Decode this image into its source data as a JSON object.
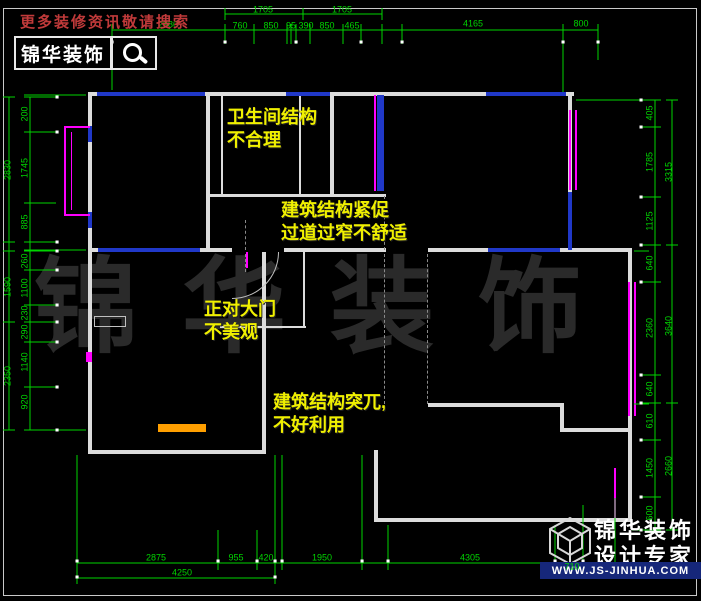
{
  "header": {
    "promo": "更多装修资讯敬请搜索",
    "brand": "锦华装饰",
    "search_icon": "magnifier-icon"
  },
  "watermark": {
    "text": "锦华装饰"
  },
  "annotations": [
    {
      "text": "卫生间结构\n不合理",
      "x": 227,
      "y": 106
    },
    {
      "text": "建筑结构紧促\n过道过窄不舒适",
      "x": 281,
      "y": 199
    },
    {
      "text": "正对大门\n不美观",
      "x": 204,
      "y": 298
    },
    {
      "text": "建筑结构突兀,\n不好利用",
      "x": 273,
      "y": 391
    }
  ],
  "dimensions": {
    "top": [
      {
        "v": "2980",
        "x": 168,
        "y": 25
      },
      {
        "v": "1705",
        "x": 263,
        "y": 10
      },
      {
        "v": "1705",
        "x": 342,
        "y": 10
      },
      {
        "v": "760",
        "x": 240,
        "y": 26
      },
      {
        "v": "850",
        "x": 271,
        "y": 26
      },
      {
        "v": "95",
        "x": 291,
        "y": 26
      },
      {
        "v": "390",
        "x": 306,
        "y": 26
      },
      {
        "v": "850",
        "x": 327,
        "y": 26
      },
      {
        "v": "465",
        "x": 352,
        "y": 26
      },
      {
        "v": "4165",
        "x": 473,
        "y": 24
      },
      {
        "v": "800",
        "x": 581,
        "y": 24
      }
    ],
    "left": [
      {
        "v": "200",
        "x": 25,
        "y": 114
      },
      {
        "v": "1745",
        "x": 25,
        "y": 168
      },
      {
        "v": "885",
        "x": 25,
        "y": 222
      },
      {
        "v": "2830",
        "x": 8,
        "y": 170
      },
      {
        "v": "260",
        "x": 25,
        "y": 261
      },
      {
        "v": "1100",
        "x": 25,
        "y": 288
      },
      {
        "v": "230",
        "x": 25,
        "y": 313
      },
      {
        "v": "1590",
        "x": 8,
        "y": 287
      },
      {
        "v": "290",
        "x": 25,
        "y": 332
      },
      {
        "v": "1140",
        "x": 25,
        "y": 362
      },
      {
        "v": "920",
        "x": 25,
        "y": 402
      },
      {
        "v": "2350",
        "x": 8,
        "y": 376
      }
    ],
    "right": [
      {
        "v": "405",
        "x": 650,
        "y": 113
      },
      {
        "v": "1785",
        "x": 650,
        "y": 162
      },
      {
        "v": "1125",
        "x": 650,
        "y": 221
      },
      {
        "v": "3315",
        "x": 669,
        "y": 172
      },
      {
        "v": "640",
        "x": 650,
        "y": 263
      },
      {
        "v": "2360",
        "x": 650,
        "y": 328
      },
      {
        "v": "640",
        "x": 650,
        "y": 389
      },
      {
        "v": "3640",
        "x": 669,
        "y": 326
      },
      {
        "v": "610",
        "x": 650,
        "y": 421
      },
      {
        "v": "1450",
        "x": 650,
        "y": 468
      },
      {
        "v": "600",
        "x": 650,
        "y": 513
      },
      {
        "v": "2660",
        "x": 669,
        "y": 466
      }
    ],
    "bottom": [
      {
        "v": "2875",
        "x": 156,
        "y": 558
      },
      {
        "v": "955",
        "x": 236,
        "y": 558
      },
      {
        "v": "420",
        "x": 266,
        "y": 558
      },
      {
        "v": "1950",
        "x": 322,
        "y": 558
      },
      {
        "v": "4305",
        "x": 470,
        "y": 558
      },
      {
        "v": "710",
        "x": 572,
        "y": 567
      },
      {
        "v": "4250",
        "x": 182,
        "y": 573
      }
    ]
  },
  "logo": {
    "line1": "锦华装饰",
    "line2": "设计专家",
    "url": "WWW.JS-JINHUA.COM"
  },
  "colors": {
    "background": "#000000",
    "dimension_green": "#00d400",
    "wall_white": "#dcdcdc",
    "window_blue": "#2038c8",
    "window_magenta": "#ff00ff",
    "counter_orange": "#ff9f00",
    "annotation_yellow": "#f0f000",
    "promo_red": "#c03a3a",
    "logo_bar_blue": "#16277a",
    "watermark_gray": "#2a2a2a"
  }
}
